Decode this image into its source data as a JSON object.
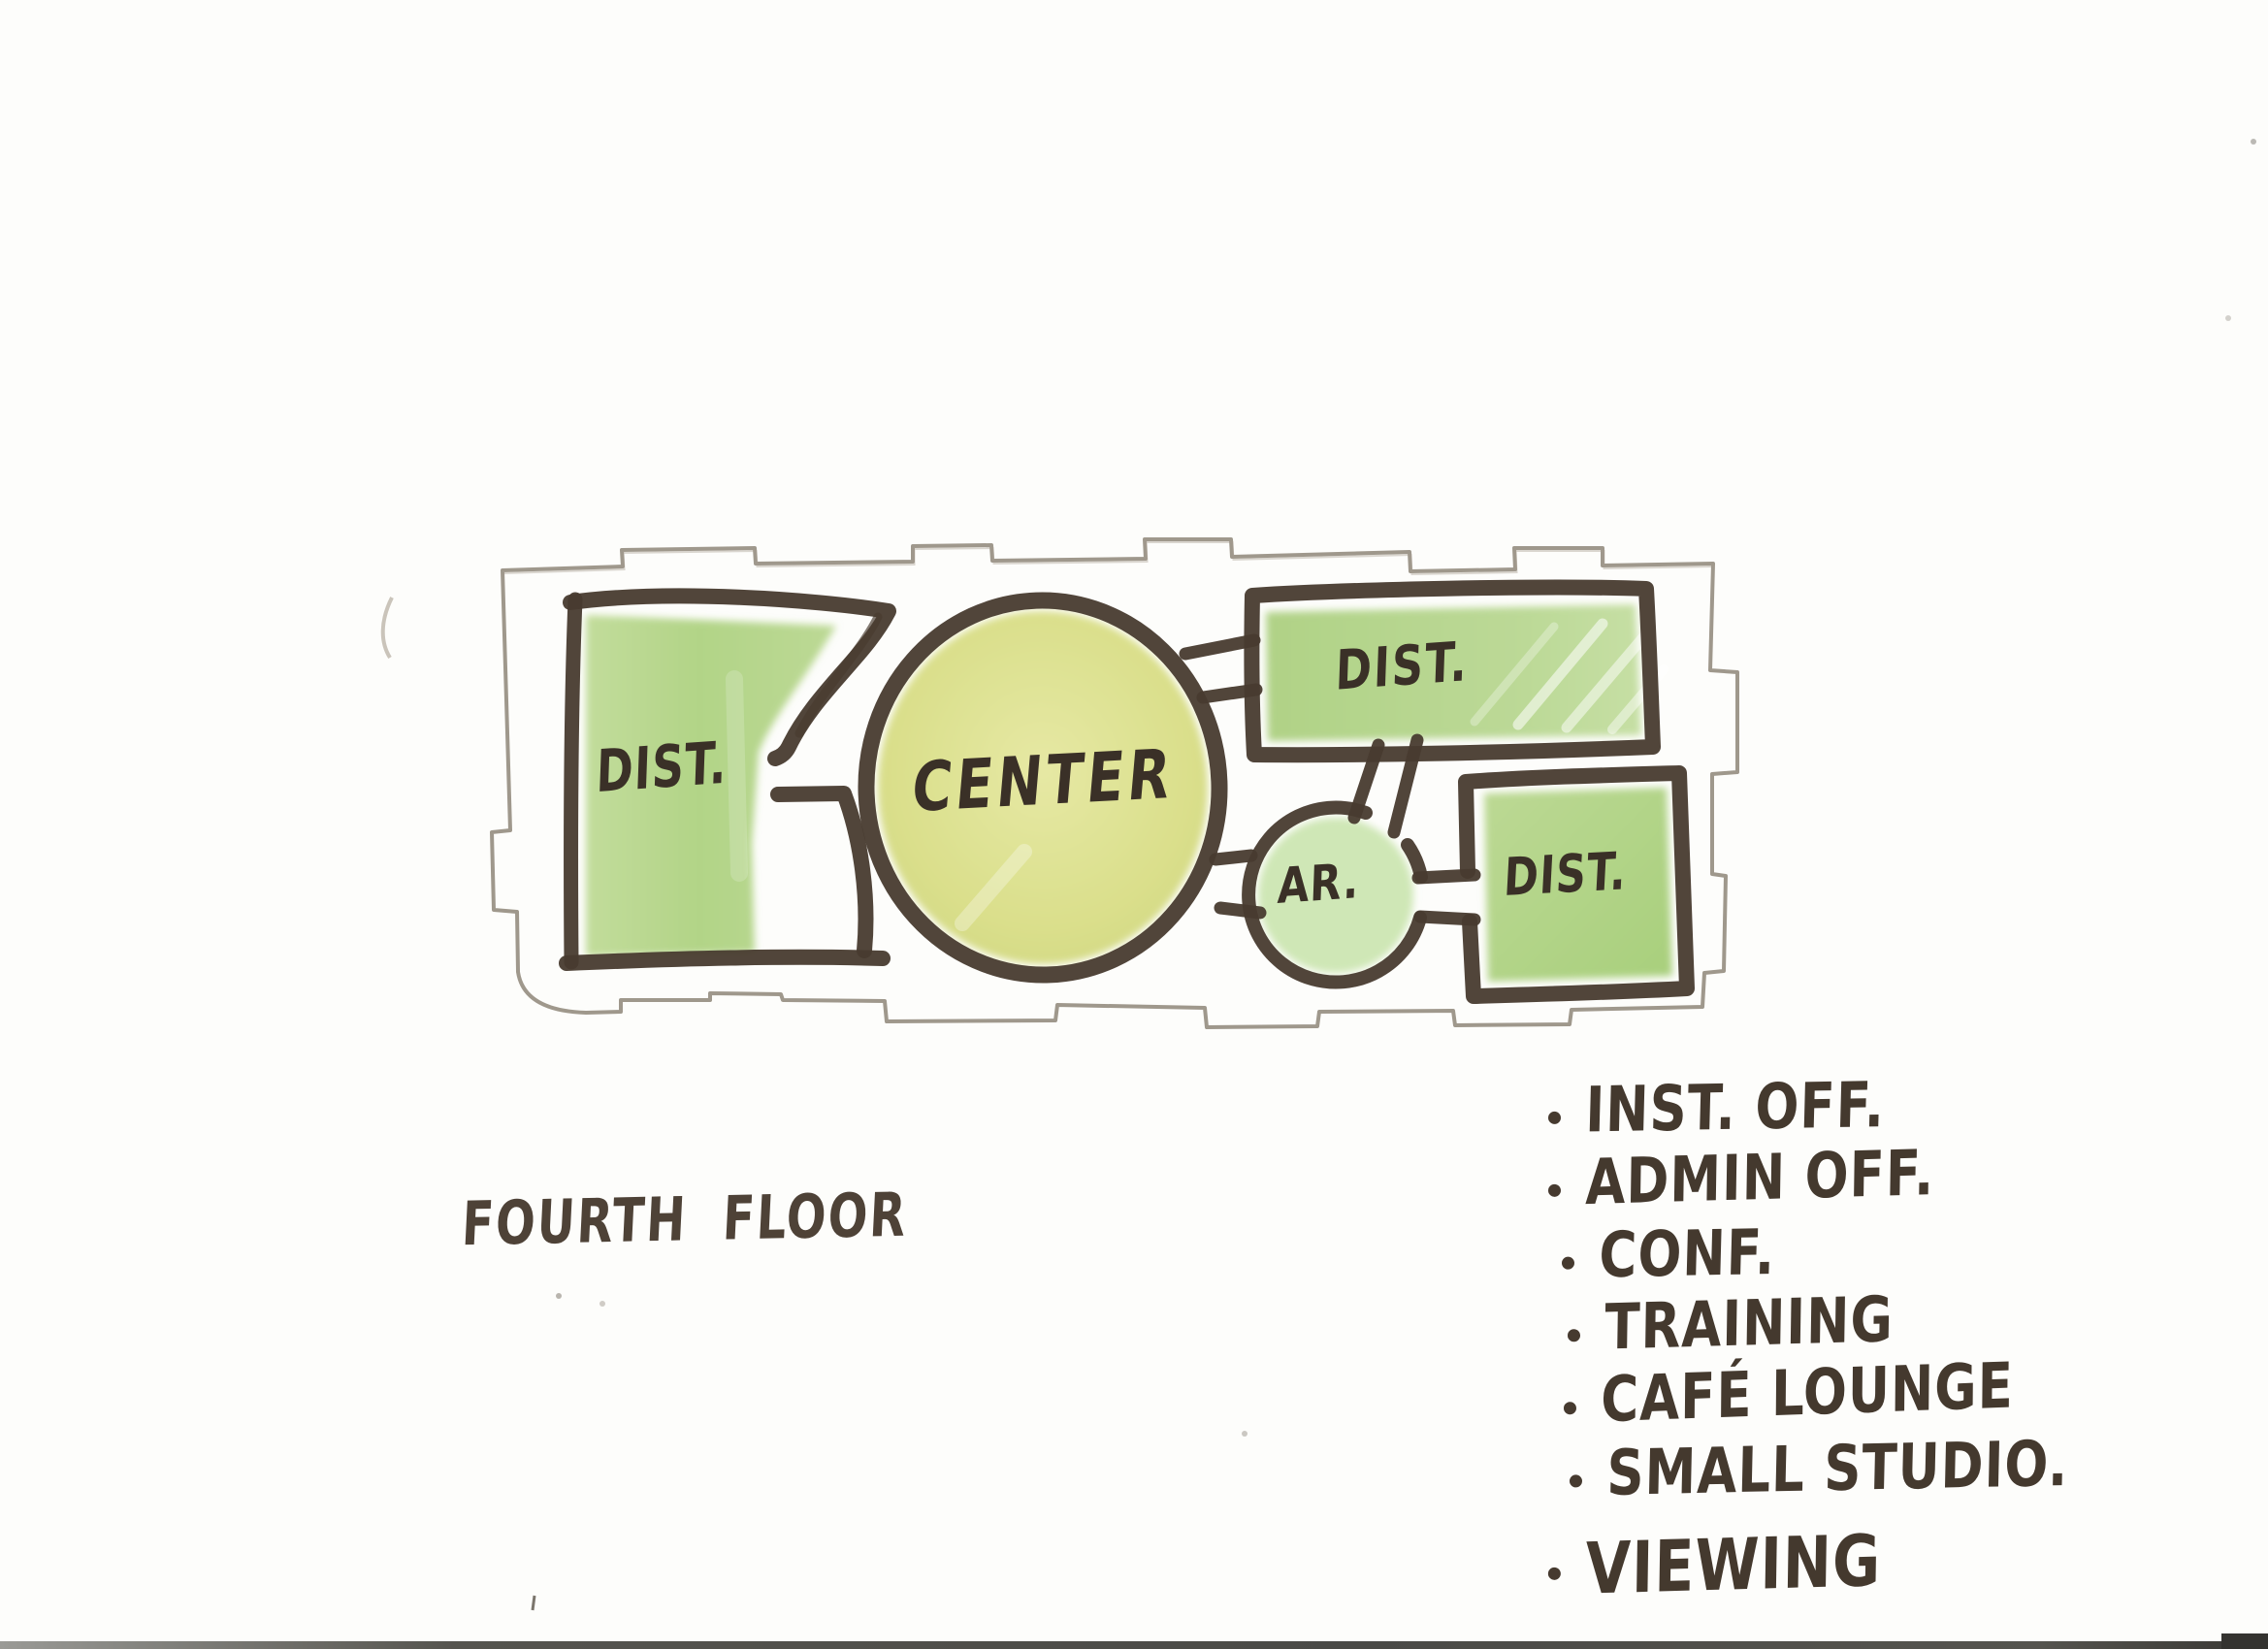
{
  "document": {
    "kind": "hand-drawn floor plan concept sketch, scanned",
    "floor_label": "FOURTH FLOOR"
  },
  "palette": {
    "paper": "#fdfdfb",
    "marker_ink": "#483b2f",
    "text_ink": "#3a3027",
    "pencil": "#8e8678",
    "room_green": "#b4d488",
    "center_yellow_green": "#d9df8c",
    "pale_green": "#cfe7b6"
  },
  "diagram": {
    "rooms": [
      {
        "id": "dist-left",
        "label": "DIST.",
        "shape": "rectangle"
      },
      {
        "id": "center",
        "label": "CENTER",
        "shape": "ellipse"
      },
      {
        "id": "dist-top-right",
        "label": "DIST.",
        "shape": "rectangle"
      },
      {
        "id": "ar",
        "label": "AR.",
        "shape": "circle"
      },
      {
        "id": "dist-bottom-right",
        "label": "DIST.",
        "shape": "square"
      }
    ],
    "connections": [
      {
        "from": "dist-left",
        "to": "center"
      },
      {
        "from": "center",
        "to": "dist-top-right"
      },
      {
        "from": "center",
        "to": "ar"
      },
      {
        "from": "dist-top-right",
        "to": "ar"
      },
      {
        "from": "ar",
        "to": "dist-bottom-right"
      }
    ]
  },
  "legend": {
    "items": [
      "INST. OFF.",
      "ADMIN OFF.",
      "CONF.",
      "TRAINING",
      "CAFÉ LOUNGE",
      "SMALL STUDIO.",
      "VIEWING"
    ]
  }
}
